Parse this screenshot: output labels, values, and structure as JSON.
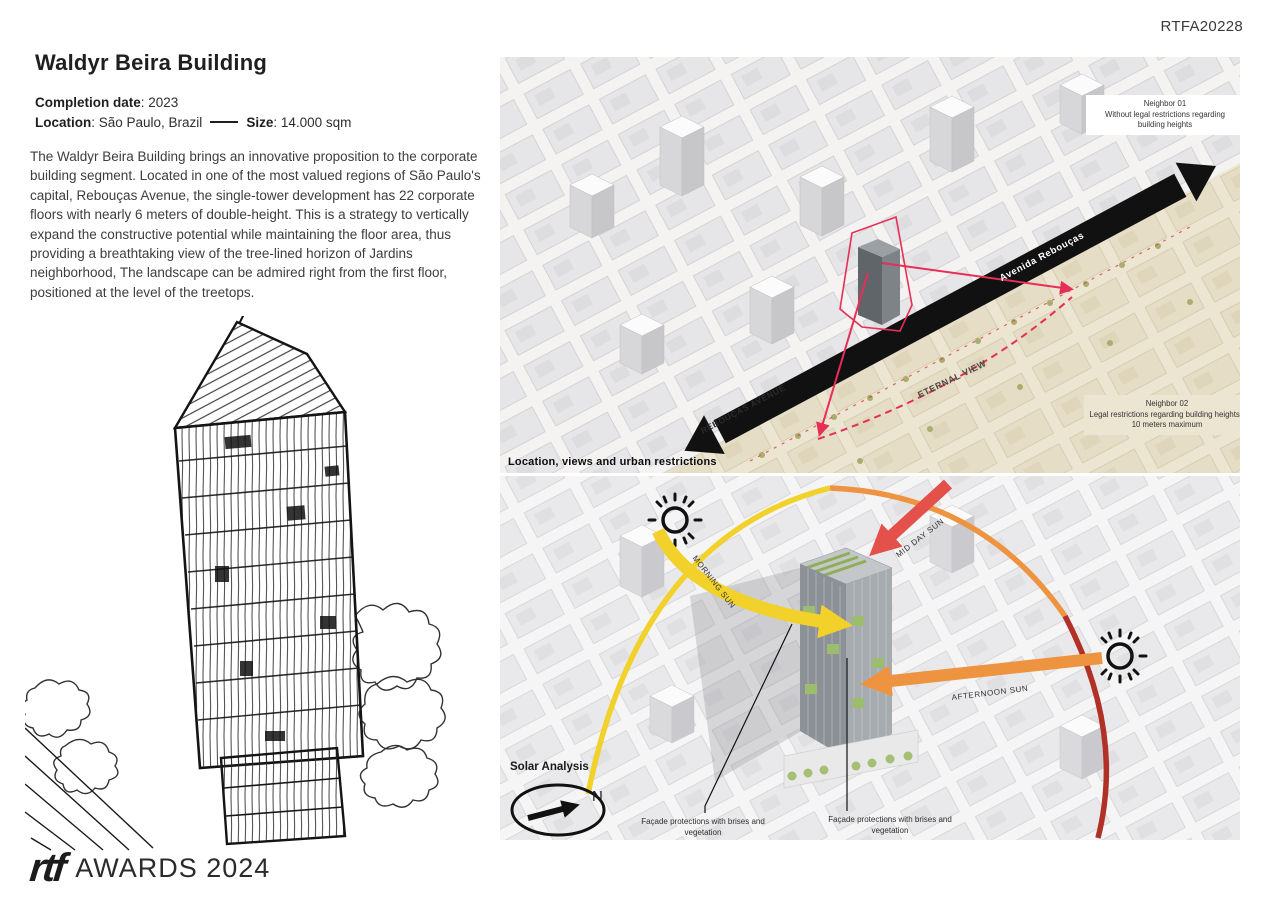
{
  "page": {
    "code": "RTFA20228"
  },
  "left": {
    "title": "Waldyr Beira Building",
    "meta": {
      "completion_label": "Completion date",
      "completion_value": ": 2023",
      "location_label": "Location",
      "location_value": ": São Paulo, Brazil",
      "size_label": "Size",
      "size_value": ": 14.000 sqm"
    },
    "paragraph": "The Waldyr Beira Building brings an innovative proposition to the corporate building segment. Located in one of the most valued regions of São Paulo's capital, Rebouças Avenue, the single-tower development has 22 corporate floors with nearly 6 meters of double-height. This is a strategy to vertically expand the constructive potential while maintaining the floor area, thus providing a breathtaking view of the tree-lined horizon of Jardins neighborhood, The landscape can be admired right from the first floor, positioned at the level of the treetops.",
    "logo": {
      "mark": "rtf",
      "text": "AWARDS 2024"
    }
  },
  "location_map": {
    "caption": "Location, views and urban restrictions",
    "avenue_label": "Avenida Rebouças",
    "avenue_street_label": "REBOUÇAS AVENUE",
    "eternal_view": "ETERNAL VIEW",
    "neighbor1": {
      "title": "Neighbor 01",
      "desc": "Without legal restrictions regarding building heights"
    },
    "neighbor2": {
      "title": "Neighbor 02",
      "desc": "Legal restrictions regarding building heights - 10 meters maximum"
    }
  },
  "solar": {
    "title": "Solar Analysis",
    "north": "N",
    "morning": "MORNING SUN",
    "midday": "MID DAY SUN",
    "afternoon": "AFTERNOON SUN",
    "facade1": "Façade protections with brises and vegetation",
    "facade2": "Façade protections with brises and vegetation"
  },
  "colors": {
    "accent_red": "#e62e56",
    "avenue_black": "#111111",
    "beige_zone": "#ece5d1",
    "tree_green": "#a9ad6d",
    "arc_yellow": "#f2d12b",
    "arc_orange": "#ee9440",
    "arc_red": "#b23127",
    "midday_red": "#e4504a",
    "vegetation_green": "#9dbd6e"
  }
}
